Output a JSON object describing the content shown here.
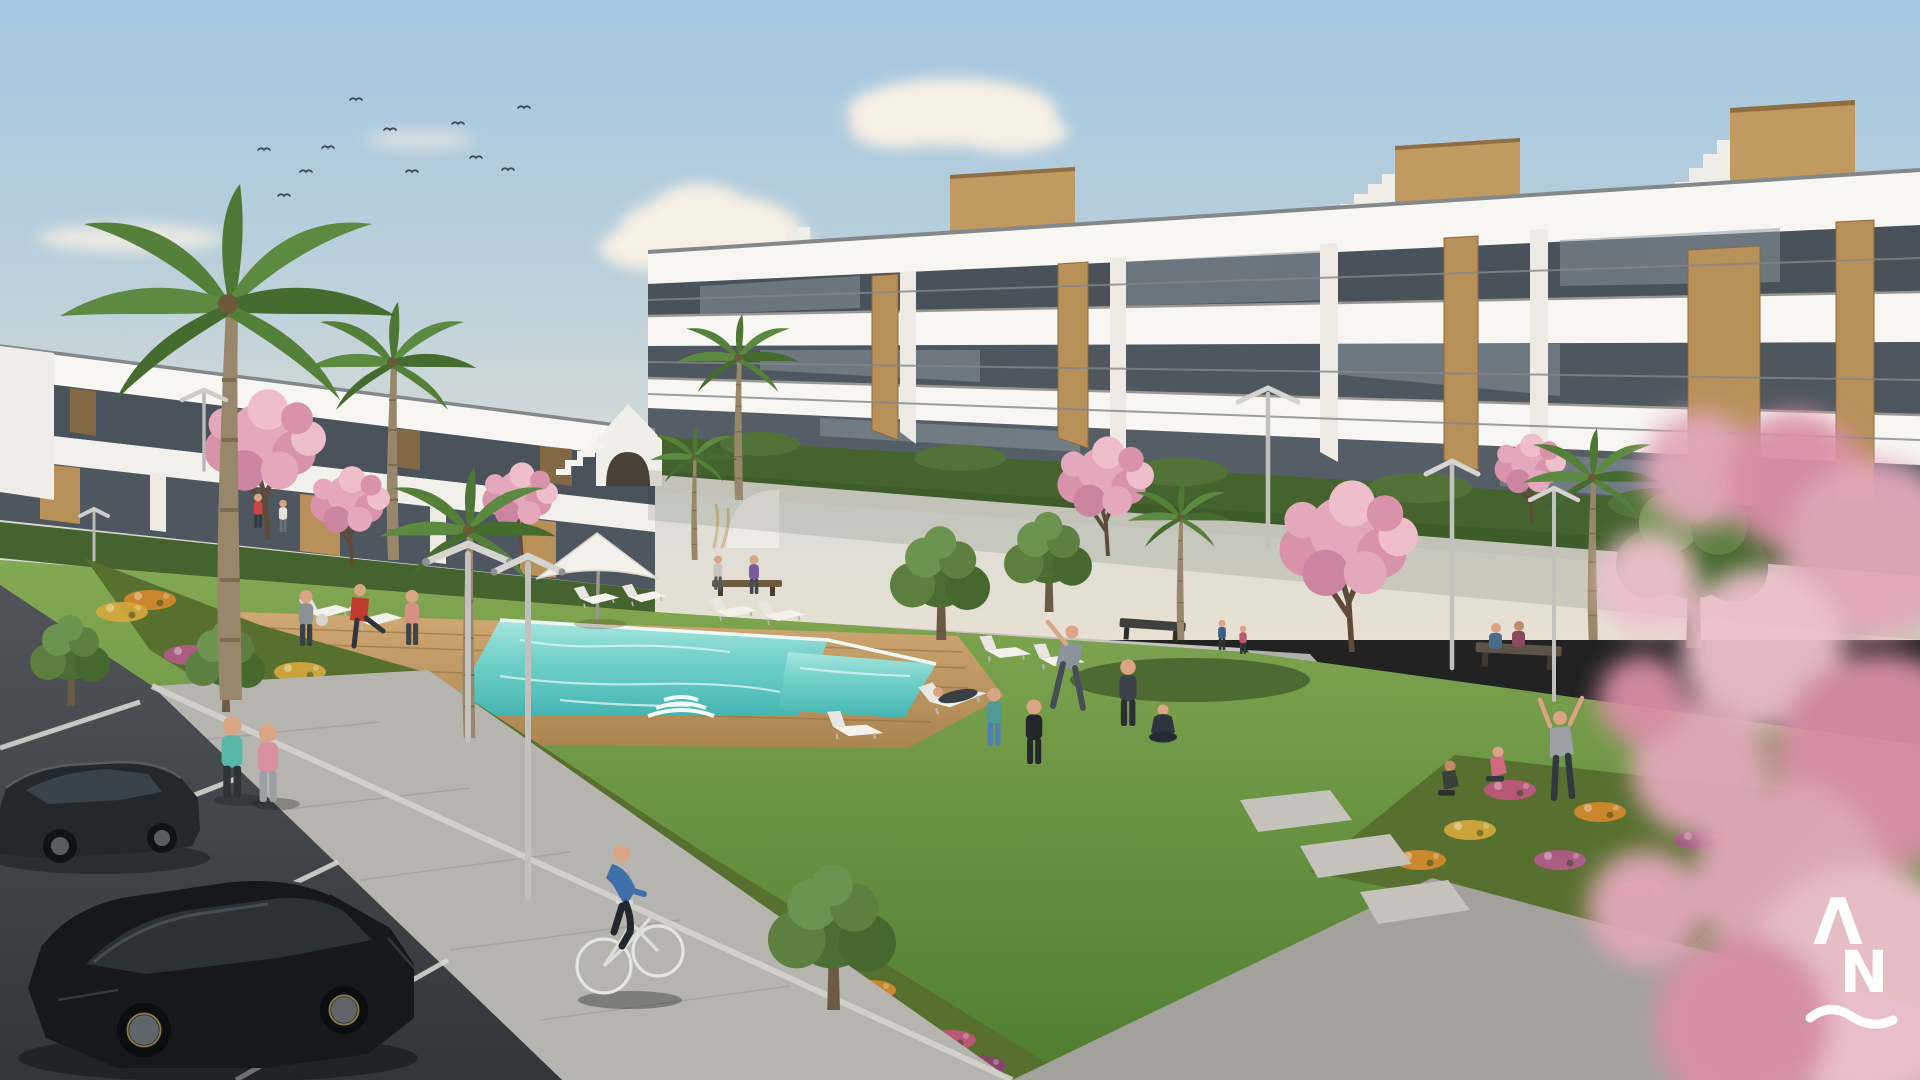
{
  "image": {
    "kind": "architectural-render",
    "subject": "Modern white apartment complex with communal pool, gardens, lawn and parking",
    "time_of_day": "daytime"
  },
  "watermark": {
    "letter_a": "Λ",
    "letter_n": "N",
    "wave_glyph": "~",
    "color": "#ffffff"
  },
  "palette": {
    "sky_top": "#a3c6e0",
    "sky_horizon": "#e8e0d2",
    "cloud": "#f6efe4",
    "building_white": "#f6f5f1",
    "building_shadow": "#dbd8d1",
    "glass_dark": "#49525a",
    "wood_accent": "#bb9258",
    "lawn": "#6f9a44",
    "hedge": "#44632e",
    "pool": "#5fc8c0",
    "pool_light": "#aee8e0",
    "deck_wood": "#c09a66",
    "path_gray": "#b6b4ae",
    "asphalt": "#44484c",
    "car_dark": "#1a1e22",
    "flower_orange": "#d78a2e",
    "flower_pink": "#c2577f",
    "flower_magenta": "#8f3f72",
    "blossom_pink": "#e0a2b8",
    "logo_white": "#ffffff"
  },
  "scene": {
    "objects": [
      "sky with clouds and flock of birds",
      "three-storey white apartment building with glass balconies and wood accents",
      "two-storey white apartment row",
      "turquoise swimming pool with wooden deck",
      "white sun loungers and parasol",
      "palm trees",
      "pink cherry blossom trees",
      "flower beds with orange and pink flowers",
      "street lamps",
      "parking lot with two dark cars",
      "two women jogging",
      "man cycling",
      "people exercising on lawn",
      "people sitting on benches",
      "blurred pink blossom foreground",
      "AN logo watermark"
    ],
    "counts": {
      "cars": 2,
      "pools": 1,
      "parasols": 1,
      "benches": 3
    }
  }
}
